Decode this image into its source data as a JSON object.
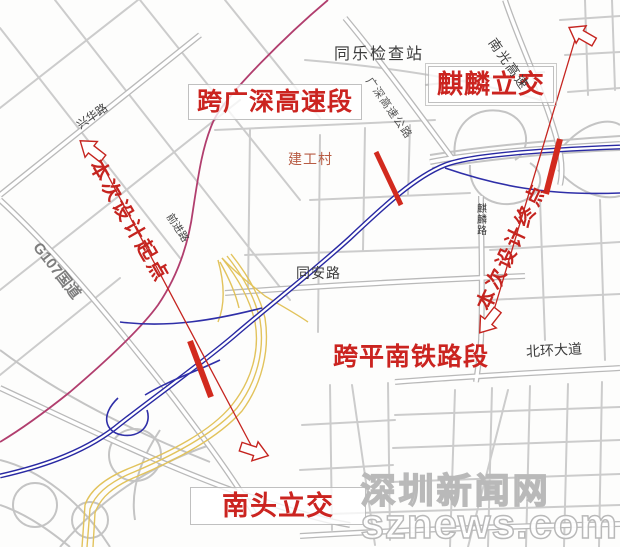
{
  "map": {
    "labels": {
      "checkpoint": "同乐检查站",
      "section_guangshen": "跨广深高速段",
      "qilin_interchange": "麒麟立交",
      "nanguang_expressway": "南光高速",
      "guangshen_expressway_road": "广深高速公路",
      "xinghua_road": "兴华路",
      "design_start": "本次设计起点",
      "g107_national_road": "G107国道",
      "qianjin_road": "前进路",
      "jiangong_village": "建工村",
      "tongan_road": "同安路",
      "qilin_road": "麒麟路",
      "design_end": "本次设计终点",
      "section_pingnan_railway": "跨平南铁路段",
      "beihuan_avenue": "北环大道",
      "nantou_interchange": "南头立交"
    },
    "colors": {
      "annotation_red": "#c5241f",
      "alignment_blue": "#2929a3",
      "railway_yellow": "#e2c35c",
      "boundary_magenta": "#b13e6e",
      "road_gray": "#bcbcbc",
      "village_label": "#b85c44"
    },
    "watermark": {
      "line1": "深圳新闻网",
      "line2": "sznews.com"
    }
  }
}
